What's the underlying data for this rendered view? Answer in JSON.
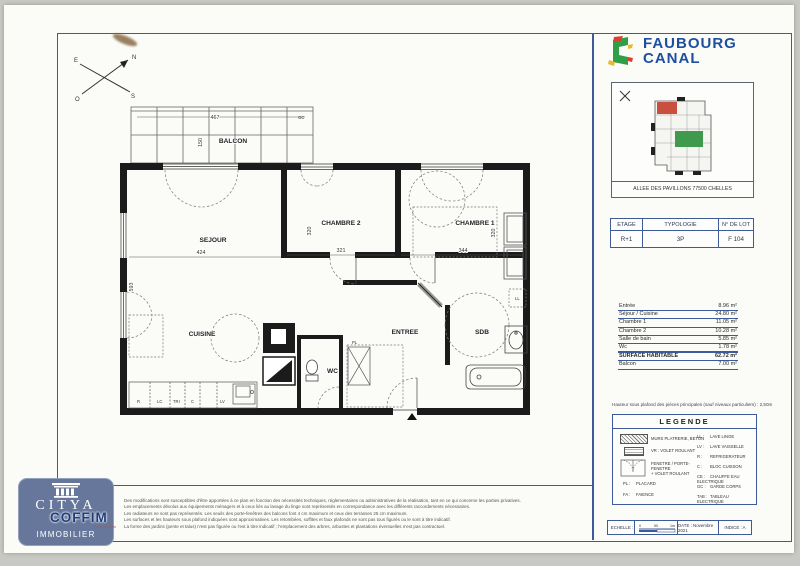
{
  "brand": {
    "line1": "FAUBOURG",
    "line2": "CANAL"
  },
  "site": {
    "address": "ALLEE DES PAVILLONS 77500 CHELLES"
  },
  "lot": {
    "headers": [
      "ETAGE",
      "TYPOLOGIE",
      "N° DE LOT"
    ],
    "etage": "R+1",
    "typologie": "3P",
    "numero": "F 104"
  },
  "surfaces": {
    "rows": [
      {
        "label": "Entrée",
        "value": "8.96 m²"
      },
      {
        "label": "Séjour / Cuisine",
        "value": "24.80 m²"
      },
      {
        "label": "Chambre 1",
        "value": "11.05 m²"
      },
      {
        "label": "Chambre 2",
        "value": "10.28 m²"
      },
      {
        "label": "Salle de bain",
        "value": "5.85 m²"
      },
      {
        "label": "Wc",
        "value": "1.78 m²"
      },
      {
        "label": "SURFACE HABITABLE",
        "value": "62.72 m²"
      },
      {
        "label": "Balcon",
        "value": "7.00 m²"
      }
    ]
  },
  "ceiling_note": "Hauteur sous plafond des pièces principales (sauf niveaux particuliers) : 2,50m",
  "legend": {
    "title": "LEGENDE",
    "left": [
      {
        "text": "MURS PLATRERIE, BETON"
      },
      {
        "text": "VR : VOLET ROULANT"
      },
      {
        "text": "FENETRE / PORTE-FENETRE",
        "text2": "+ VOLET ROULANT"
      },
      {
        "abbr": "PL :",
        "text": "PLACARD"
      },
      {
        "abbr": "FA :",
        "text": "FAIENCE"
      }
    ],
    "right": [
      {
        "abbr": "LL :",
        "text": "LAVE LINGE"
      },
      {
        "abbr": "LV :",
        "text": "LAVE VAISSELLE"
      },
      {
        "abbr": "R :",
        "text": "REFRIGERATEUR"
      },
      {
        "abbr": "C :",
        "text": "BLOC CUISSON"
      },
      {
        "abbr": "CE :",
        "text": "CHAUFFE EAU ELECTRIQUE"
      },
      {
        "abbr": "GC :",
        "text": "GARDE CORPS"
      },
      {
        "abbr": "TAB :",
        "text": "TABLEAU ELECTRIQUE"
      }
    ]
  },
  "plan": {
    "rooms": {
      "balcon": "BALCON",
      "sejour": "SEJOUR",
      "chambre2": "CHAMBRE 2",
      "chambre1": "CHAMBRE 1",
      "cuisine": "CUISINE",
      "entree": "ENTREE",
      "sdb": "SDB",
      "wc": "WC"
    },
    "dims": {
      "balcon_w": "467",
      "balcon_d": "150",
      "sejour_w": "424",
      "sejour_h": "593",
      "ch2_w": "321",
      "ch2_h": "320",
      "ch1_w": "344",
      "ch1_h": "320"
    },
    "tags": {
      "gc": "GC",
      "pl": "PL",
      "ll": "LL",
      "r": "R",
      "lc": "LC",
      "tri": "TRI",
      "c": "C",
      "lv": "LV"
    },
    "compass": {
      "n": "N",
      "e": "E",
      "s": "S",
      "o": "O"
    }
  },
  "footer": {
    "disclaimer": [
      "Des modifications sont susceptibles d'être apportées à ce plan en fonction des nécessités techniques, réglementaires ou administratives de la réalisation, tant en ce qui concerne les parties privatives.",
      "Les emplacements dévolus aux équipements ménagers et à ceux liés au lavage du linge sont représentés en correspondance avec les différents raccordements nécessaires.",
      "Les radiateurs ne sont pas représentés. Les seuils des porte-fenêtres des balcons font 4 cm maximum et ceux des terrasses 25 cm maximum.",
      "Les surfaces et les hauteurs sous plafond indiquées sont approximatives. Les retombées, soffites et faux plafonds ne sont pas tous figurés ou le sont à titre indicatif.",
      "La forme des jardins (pente et talus) n'est pas figurée ou l'est à titre indicatif ; l'emplacement des arbres, arbustes et plantations éventuelles n'est pas contractuel."
    ],
    "scale_label": "ECHELLE :",
    "scale_ticks": [
      "0",
      "50",
      "1m"
    ],
    "date": "DATE : Novembre 2021",
    "indice": "INDICE : A"
  },
  "logo": {
    "brand": "CITYA",
    "sub": "IMMOBILIER",
    "partner": "COFFIM",
    "tagline": "pour demain"
  },
  "colors": {
    "frame_blue": "#3d5a99",
    "brand_blue": "#1d4f9e",
    "unit_red": "#c9503f",
    "unit_green": "#3f9a4d"
  }
}
